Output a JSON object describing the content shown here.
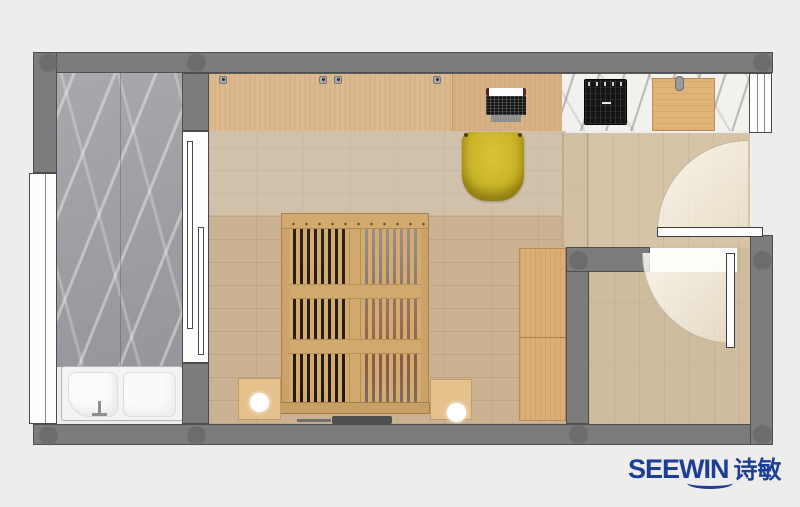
{
  "branding": {
    "logo_text": "SEEWIN",
    "logo_cjk": "诗敏",
    "logo_color": "#1c3e96"
  },
  "palette": {
    "page_background": "#ededed",
    "wall_gray": "#7c7c7c",
    "wall_outline": "#4f4f4f",
    "bathroom_marble": "#a2a1a6",
    "bedroom_wood": "#cbb293",
    "entry_wood": "#d7c4a7",
    "small_room_wood": "#cfbc9e",
    "desk_wood": "#dcba8e",
    "wardrobe_wood": "#dcae74",
    "bed_wood": "#d2a96c",
    "chair_yellow": "#c9b527",
    "counter_marble": "#f2f1ee",
    "cooktop_black": "#141414",
    "cutting_board": "#e0b377",
    "fixture_white": "#f3f3f3"
  }
}
